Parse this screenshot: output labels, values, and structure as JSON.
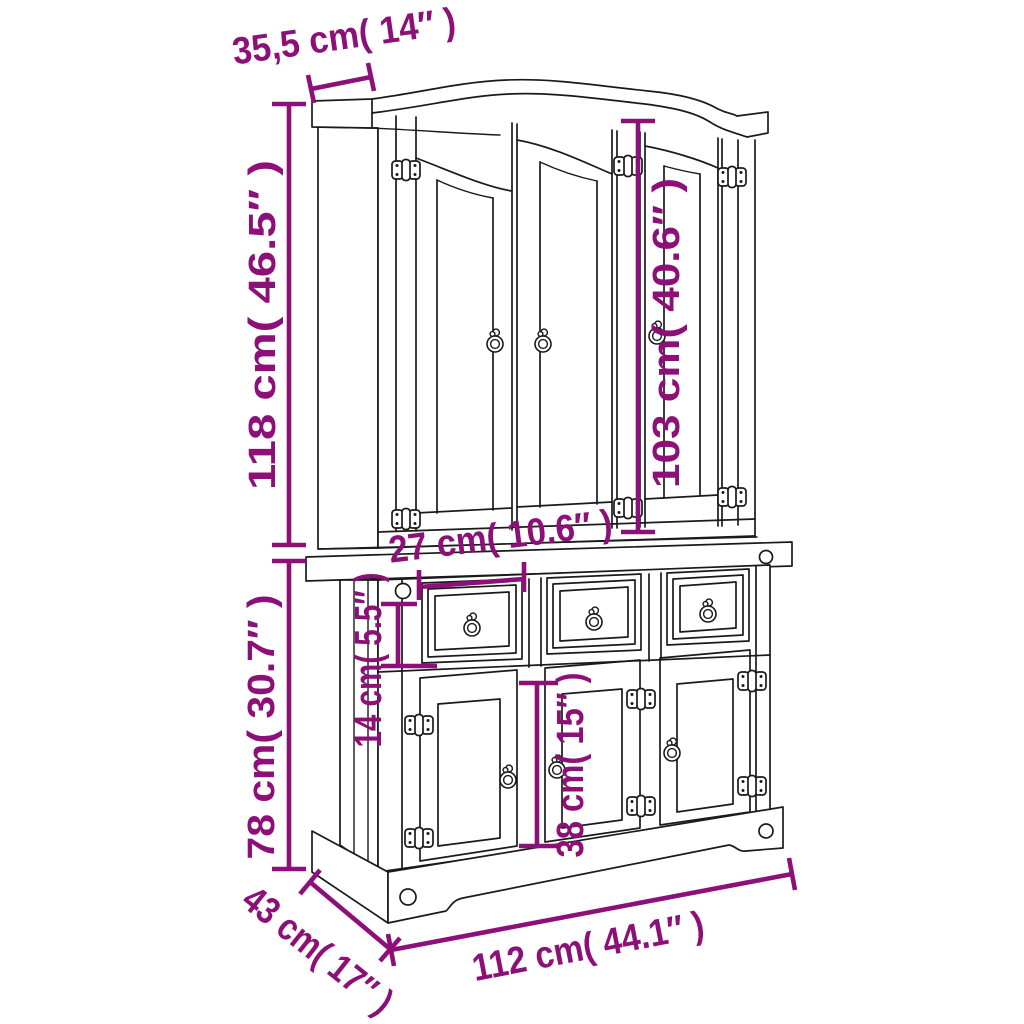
{
  "diagram": {
    "subject": "buffet hutch display cabinet dimension line drawing",
    "background_color": "#ffffff",
    "line_color": "#1a1a1a",
    "dimension_color": "#8d1078",
    "dimensions": {
      "top_depth": {
        "label": "35,5 cm( 14″ )",
        "cm": "35,5",
        "inch": "14″"
      },
      "hutch_height": {
        "label": "118 cm( 46.5″ )",
        "cm": "118",
        "inch": "46.5″"
      },
      "hutch_door_height": {
        "label": "103 cm( 40.6″ )",
        "cm": "103",
        "inch": "40.6″"
      },
      "drawer_width": {
        "label": "27 cm( 10.6″ )",
        "cm": "27",
        "inch": "10.6″"
      },
      "drawer_height": {
        "label": "14 cm( 5.5″ )",
        "cm": "14",
        "inch": "5.5″"
      },
      "base_height": {
        "label": "78 cm( 30.7″ )",
        "cm": "78",
        "inch": "30.7″"
      },
      "base_door_height": {
        "label": "38 cm( 15″ )",
        "cm": "38",
        "inch": "15″"
      },
      "depth": {
        "label": "43 cm( 17″ )",
        "cm": "43",
        "inch": "17″"
      },
      "width": {
        "label": "112 cm( 44.1″ )",
        "cm": "112",
        "inch": "44.1″"
      }
    },
    "hardware": {
      "hinge_icon_count": 12,
      "ring_pull_icon_count": 9
    }
  }
}
